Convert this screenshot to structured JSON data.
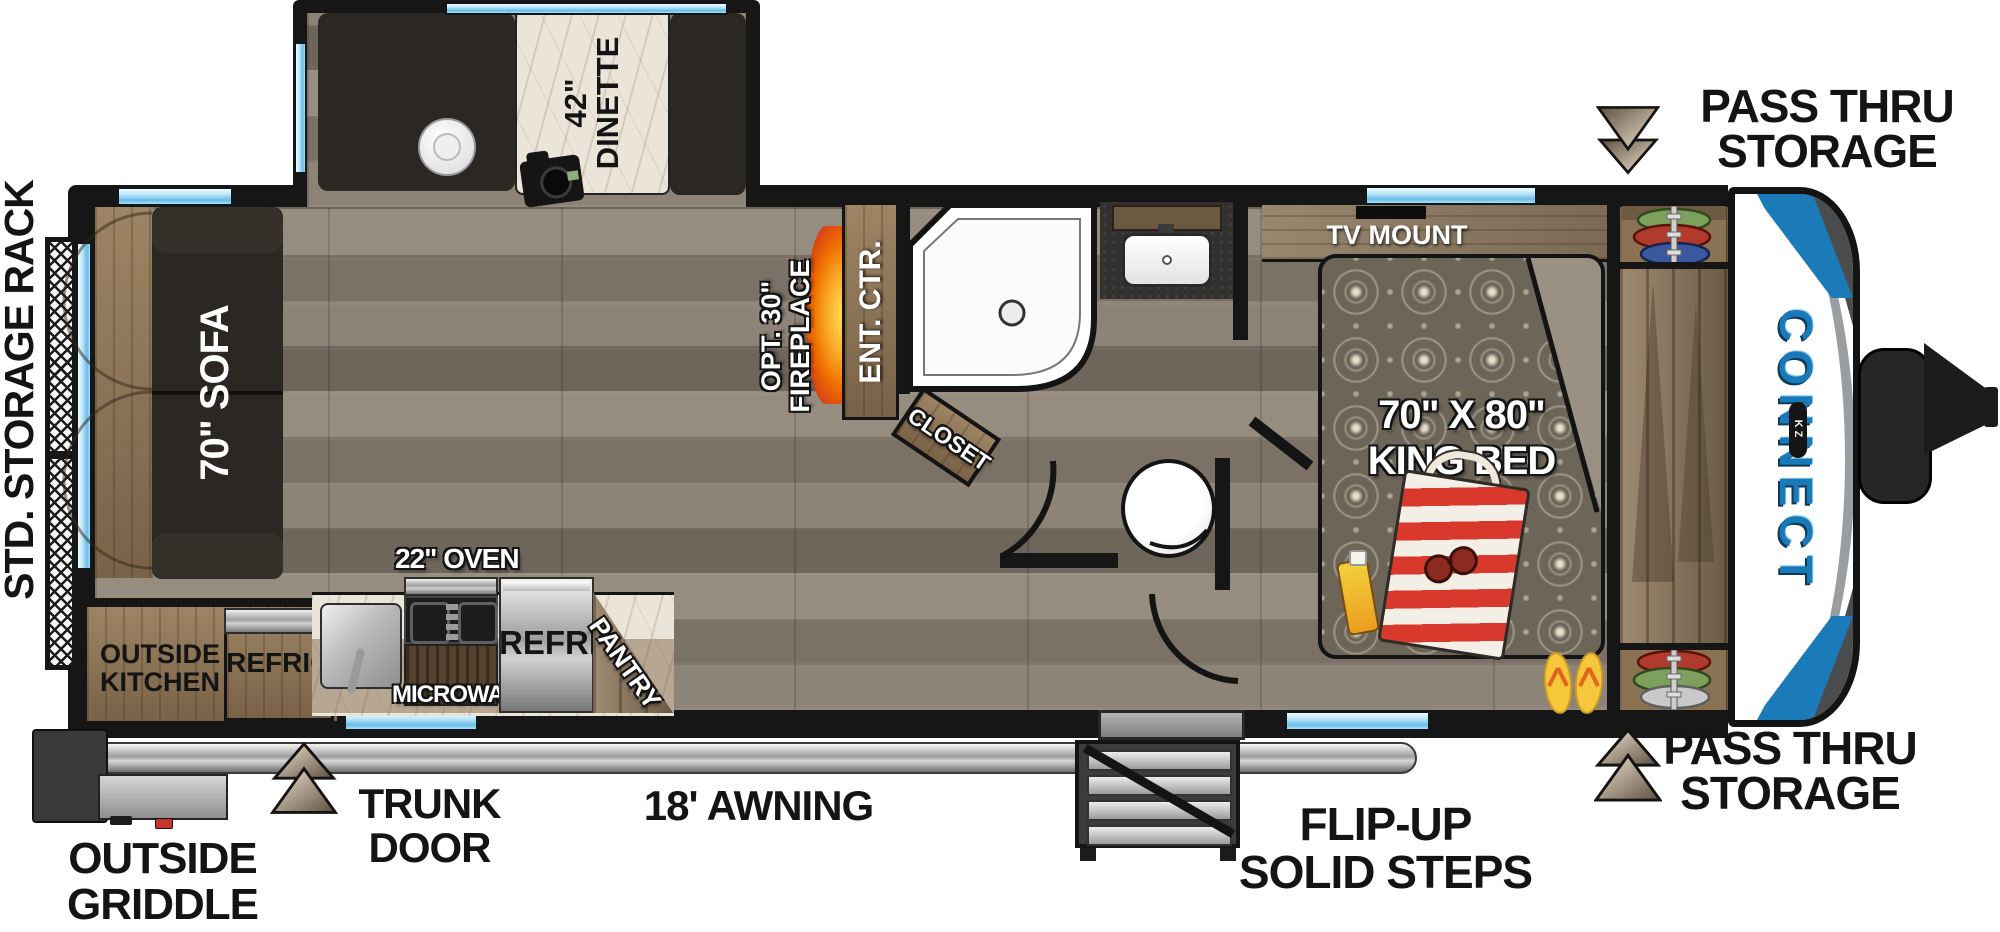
{
  "floorplan": {
    "brand": "CONNECT",
    "brand_badge": "KZ",
    "labels": {
      "storage_rack": "STD. STORAGE RACK",
      "dinette_size": "42\"",
      "dinette": "DINETTE",
      "sofa": "70\" SOFA",
      "fireplace_opt": "OPT. 30\"",
      "fireplace": "FIREPLACE",
      "ent_ctr": "ENT. CTR.",
      "closet": "CLOSET",
      "tv_mount": "TV MOUNT",
      "bed_size": "70\" X 80\"",
      "bed": "KING BED",
      "pass_thru_1": "PASS THRU",
      "pass_thru_2": "STORAGE",
      "outside_1": "OUTSIDE",
      "outside_kitchen_2": "KITCHEN",
      "outside_refrig": "REFRIG",
      "oven": "22\" OVEN",
      "microwave": "MICROWAVE",
      "refrig": "REFRIG",
      "pantry": "PANTRY",
      "griddle_2": "GRIDDLE",
      "trunk_1": "TRUNK",
      "trunk_2": "DOOR",
      "awning": "18' AWNING",
      "steps_1": "FLIP-UP",
      "steps_2": "SOLID STEPS"
    },
    "icons": {
      "pass_thru_top": "double-triangle-down",
      "pass_thru_bottom": "double-triangle-up",
      "trunk_door": "double-triangle-up"
    },
    "colors": {
      "wall": "#161616",
      "window_blue": "#8fd0ef",
      "brand_blue": "#1b7ab8",
      "floor_wood": "#877d71",
      "cabinet_wood": "#8a7254",
      "sofa_dark": "#2b2722",
      "fireplace_orange": "#f08c1e",
      "disc_green": "#7da05c",
      "disc_red": "#b13a2c",
      "disc_blue": "#3b57a0",
      "disc_silver": "#c9c9c9",
      "flipflop_yellow": "#f6c73b",
      "bag_red": "#d8392c",
      "arrow_tan": "#cbb9a2",
      "awning_silver": "#c9c9c9"
    }
  }
}
